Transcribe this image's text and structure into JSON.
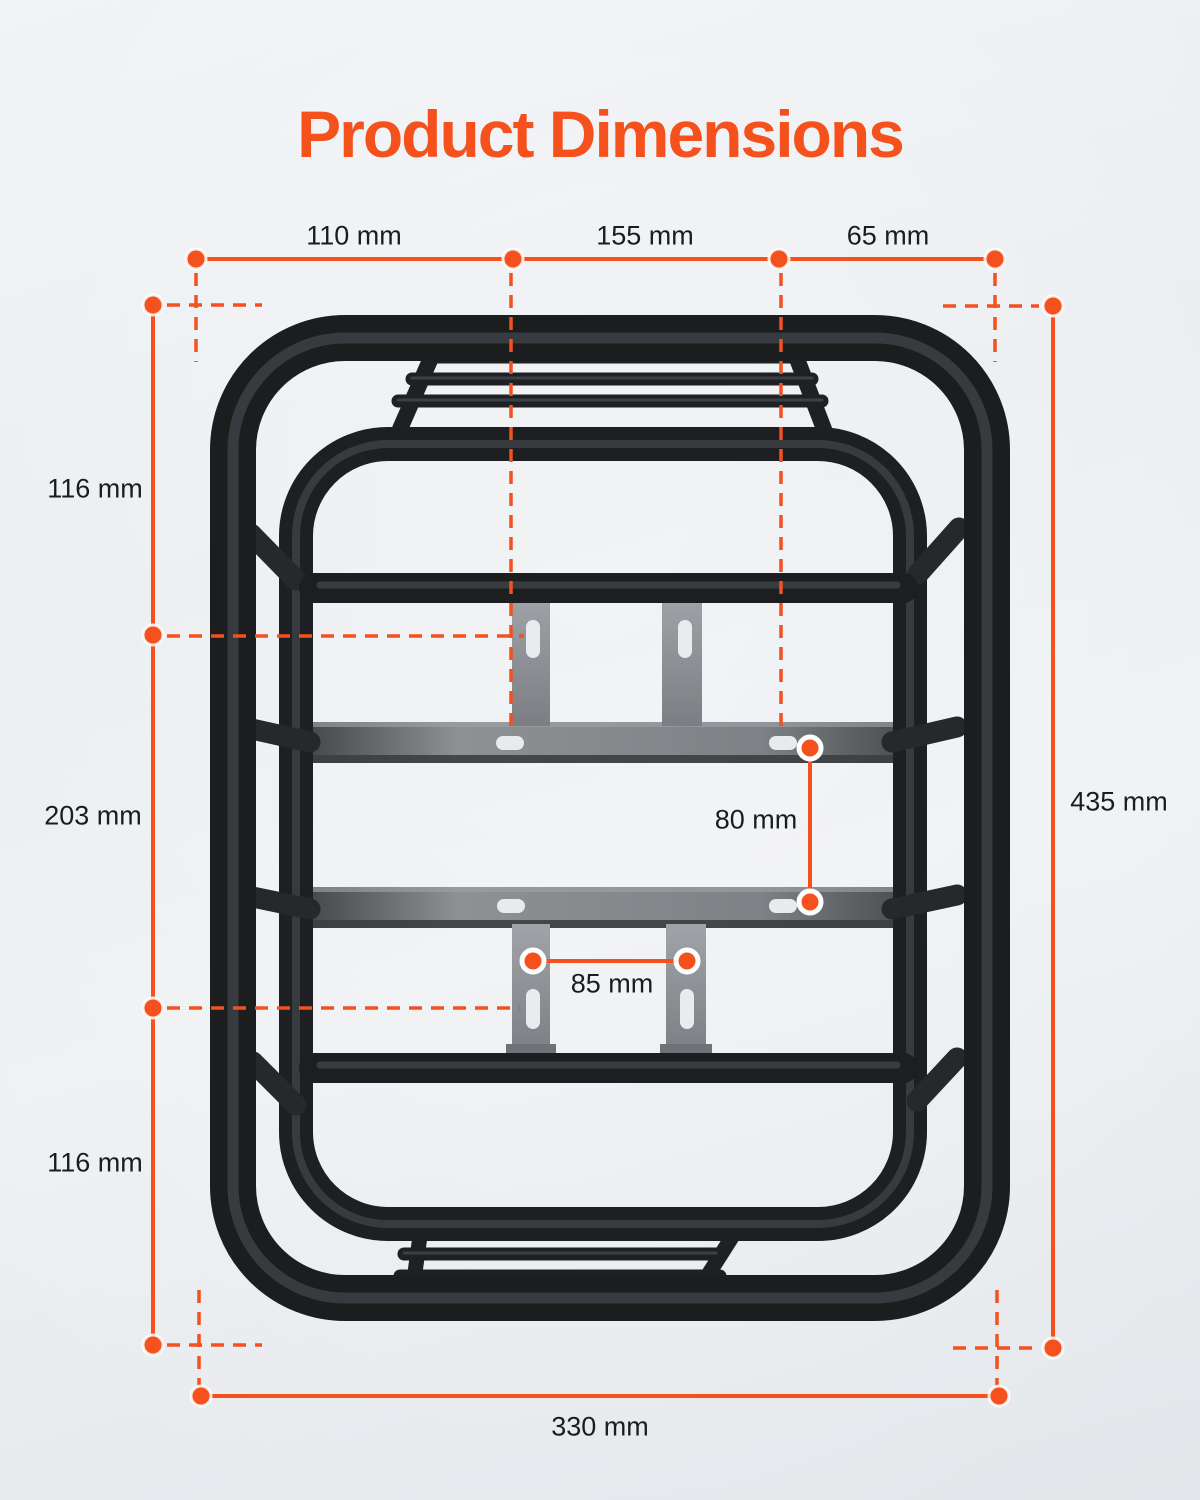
{
  "title": "Product Dimensions",
  "accent_color": "#F4511E",
  "text_color": "#1B1C1E",
  "product": "front cargo rack top view",
  "dimensions": {
    "top_segment_left": "110 mm",
    "top_segment_middle": "155 mm",
    "top_segment_right": "65 mm",
    "left_top": "116 mm",
    "left_middle": "203 mm",
    "left_bottom": "116 mm",
    "right_total_height": "435 mm",
    "bottom_total_width": "330 mm",
    "slot_vertical_spacing": "80 mm",
    "slot_horizontal_spacing": "85 mm"
  }
}
